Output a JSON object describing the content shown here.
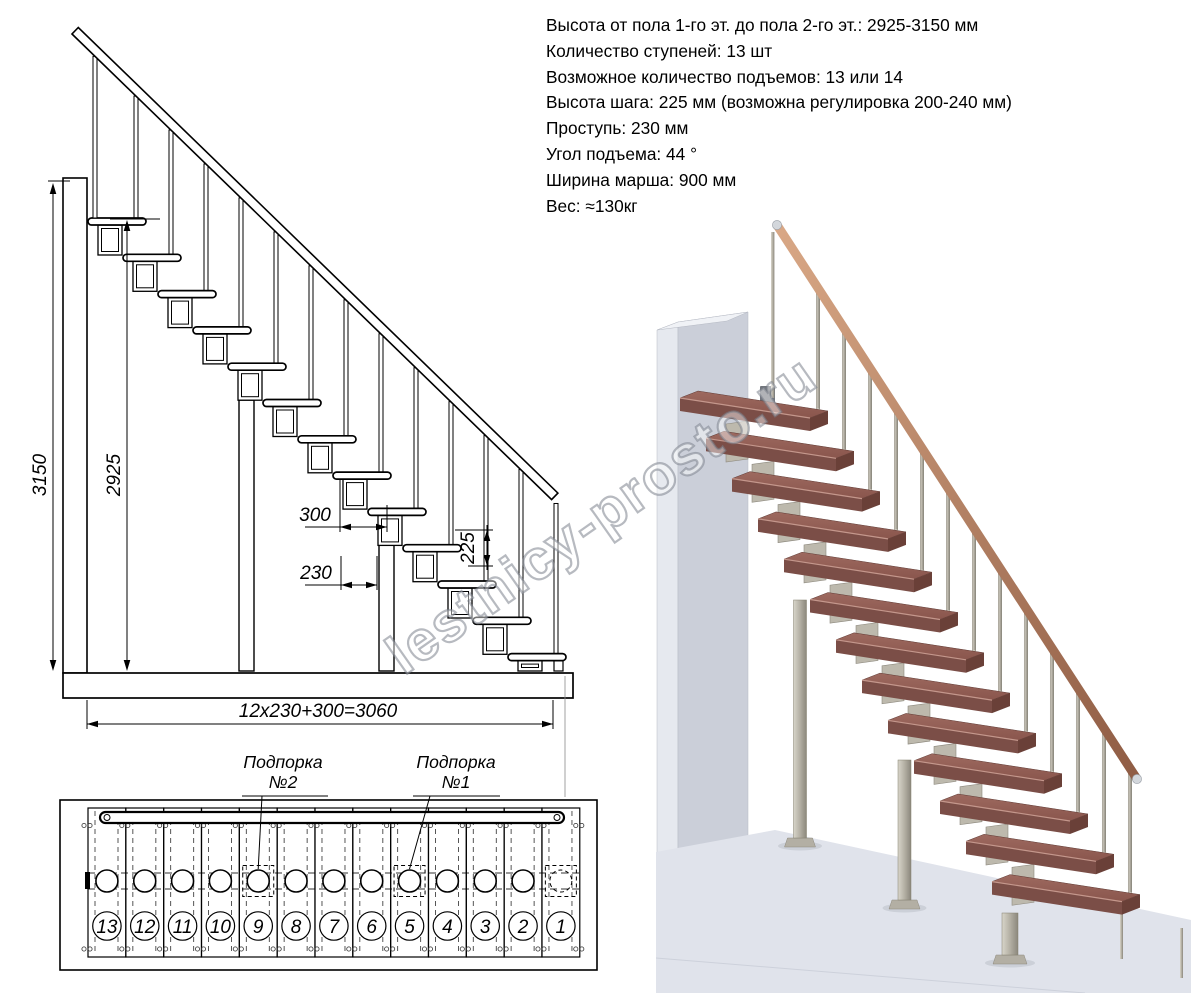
{
  "specs": {
    "lines": [
      "Высота от пола 1-го эт. до пола 2-го эт.: 2925-3150 мм",
      "Количество ступеней: 13 шт",
      "Возможное количество подъемов: 13 или 14",
      "Высота шага: 225 мм (возможна регулировка 200-240 мм)",
      "Проступь: 230 мм",
      "Угол подъема: 44 °",
      "Ширина марша: 900 мм",
      "Вес: ≈130кг"
    ]
  },
  "elevation": {
    "steps_count": 13,
    "dim_total_height": "3150",
    "dim_floor_height": "2925",
    "dim_module": "300",
    "dim_tread": "230",
    "dim_riser": "225",
    "dim_total_run": "12x230+300=3060"
  },
  "plan": {
    "step_numbers": [
      "13",
      "12",
      "11",
      "10",
      "9",
      "8",
      "7",
      "6",
      "5",
      "4",
      "3",
      "2",
      "1"
    ],
    "support2_line1": "Подпорка",
    "support2_line2": "№2",
    "support1_line1": "Подпорка",
    "support1_line2": "№1"
  },
  "watermark": {
    "text": "lestnicy-prosto.ru"
  },
  "render3d": {
    "colors": {
      "tread_top": "#96615A",
      "tread_front": "#7B4E47",
      "tread_end": "#6A4038",
      "metal": "#BDB9AD",
      "rail": "#B5795C",
      "wall_front": "#CBCFD9",
      "wall_side": "#E6E9EF",
      "floor": "#E0E3EB"
    }
  }
}
